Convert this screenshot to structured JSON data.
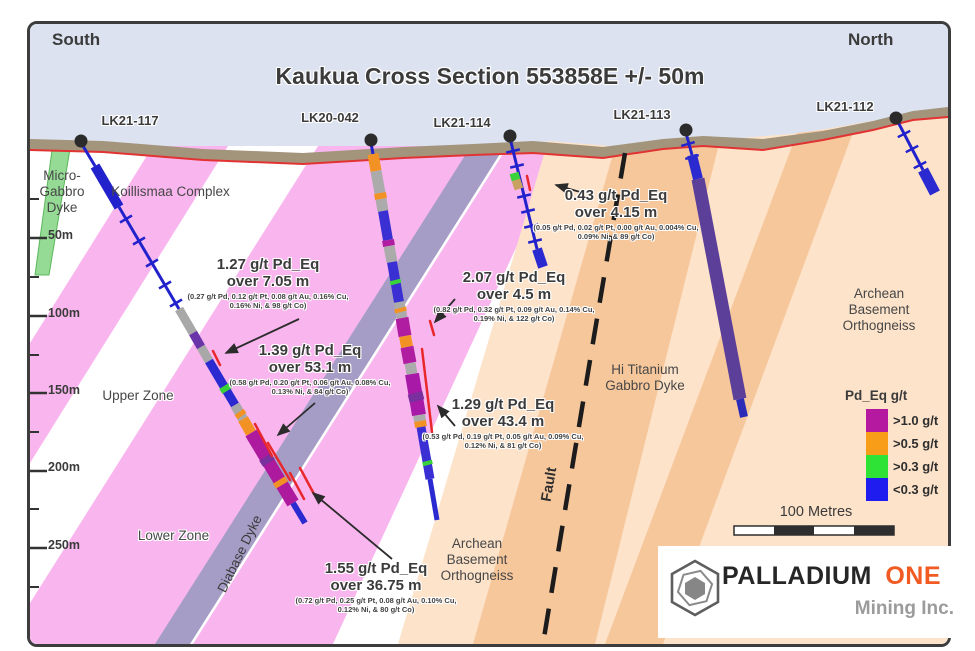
{
  "title": "Kaukua Cross Section 553858E +/- 50m",
  "direction_labels": {
    "south": "South",
    "north": "North"
  },
  "drill_holes": [
    {
      "id": "LK21-117"
    },
    {
      "id": "LK20-042"
    },
    {
      "id": "LK21-114"
    },
    {
      "id": "LK21-113"
    },
    {
      "id": "LK21-112"
    }
  ],
  "depth_labels": [
    "50m",
    "100m",
    "150m",
    "200m",
    "250m"
  ],
  "geology": {
    "micro_gabbro_dyke": "Micro-Gabbro Dyke",
    "koillismaa_complex": "Koillismaa Complex",
    "upper_zone": "Upper Zone",
    "lower_zone": "Lower Zone",
    "diabase_dyke": "Diabase Dyke",
    "hi_titanium_gabbro_dyke": "Hi Titanium Gabbro Dyke",
    "fault": "Fault",
    "archean_basement_orthogneiss": "Archean Basement Orthogneiss"
  },
  "annotations": [
    {
      "grade": "1.27 g/t Pd_Eq",
      "interval": "over 7.05 m",
      "detail": "(0.27 g/t Pd, 0.12 g/t Pt, 0.08 g/t Au, 0.16% Cu, 0.16% Ni, & 98 g/t Co)"
    },
    {
      "grade": "1.39 g/t Pd_Eq",
      "interval": "over 53.1 m",
      "detail": "(0.58 g/t Pd, 0.20 g/t Pt, 0.06 g/t Au, 0.08% Cu, 0.13% Ni, & 84 g/t Co)"
    },
    {
      "grade": "0.43 g/t Pd_Eq",
      "interval": "over 4.15 m",
      "detail": "(0.05 g/t Pd, 0.02 g/t Pt, 0.00 g/t Au, 0.004% Cu, 0.09% Ni, & 89 g/t Co)"
    },
    {
      "grade": "2.07 g/t Pd_Eq",
      "interval": "over 4.5 m",
      "detail": "(0.82 g/t Pd, 0.32 g/t Pt, 0.09 g/t Au, 0.14% Cu, 0.19% Ni, & 122 g/t Co)"
    },
    {
      "grade": "1.29 g/t Pd_Eq",
      "interval": "over 43.4 m",
      "detail": "(0.53 g/t Pd, 0.19 g/t Pt, 0.05 g/t Au, 0.09% Cu, 0.12% Ni, & 81 g/t Co)"
    },
    {
      "grade": "1.55 g/t Pd_Eq",
      "interval": "over 36.75 m",
      "detail": "(0.72 g/t Pd, 0.25 g/t Pt, 0.08 g/t Au, 0.10% Cu, 0.12% Ni, & 80 g/t Co)"
    }
  ],
  "legend": {
    "title": "Pd_Eq g/t",
    "items": [
      {
        "label": ">1.0 g/t",
        "color": "#b5199f"
      },
      {
        "label": ">0.5 g/t",
        "color": "#f89d18"
      },
      {
        "label": ">0.3 g/t",
        "color": "#2ee336"
      },
      {
        "label": "<0.3 g/t",
        "color": "#1f1cf0"
      }
    ]
  },
  "scale_bar": {
    "label": "100 Metres"
  },
  "logo": {
    "name_primary": "PALLADIUM",
    "name_accent": "ONE",
    "subtitle": "Mining Inc.",
    "accent_color": "#f15a22"
  }
}
